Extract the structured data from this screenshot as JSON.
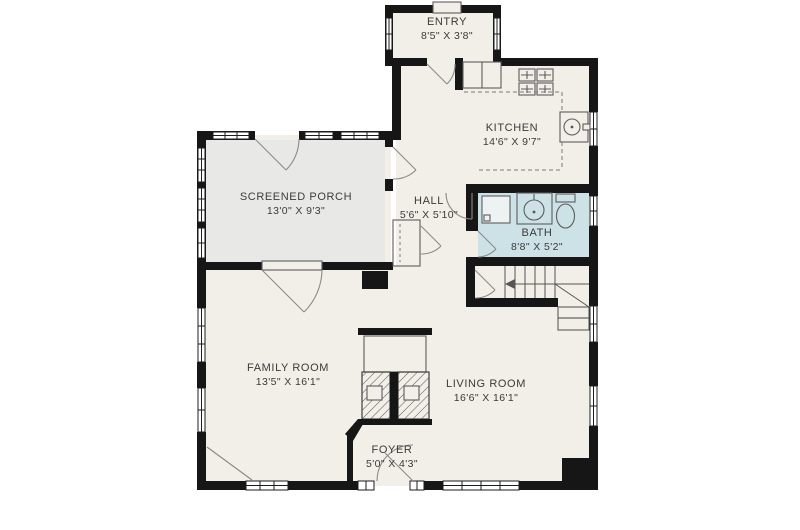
{
  "title": "First floor plan",
  "colors": {
    "background": "#ffffff",
    "wall": "#161616",
    "room_fill": "#f2eee8",
    "porch_fill": "#e8e9e7",
    "bath_fill": "#cde2e7",
    "text": "#3b3b3b"
  },
  "rooms": [
    {
      "name": "ENTRY",
      "dims": "8'5\" X 3'8\""
    },
    {
      "name": "KITCHEN",
      "dims": "14'6\" X 9'7\""
    },
    {
      "name": "SCREENED PORCH",
      "dims": "13'0\" X 9'3\""
    },
    {
      "name": "HALL",
      "dims": "5'6\" X 5'10\""
    },
    {
      "name": "BATH",
      "dims": "8'8\" X 5'2\""
    },
    {
      "name": "FAMILY ROOM",
      "dims": "13'5\" X 16'1\""
    },
    {
      "name": "LIVING ROOM",
      "dims": "16'6\" X 16'1\""
    },
    {
      "name": "FOYER",
      "dims": "5'0\" X 4'3\""
    }
  ],
  "fixtures": [
    "stove",
    "refrigerator",
    "kitchen-sink",
    "shower",
    "vanity-sink",
    "toilet",
    "staircase",
    "fireplace",
    "closet"
  ]
}
